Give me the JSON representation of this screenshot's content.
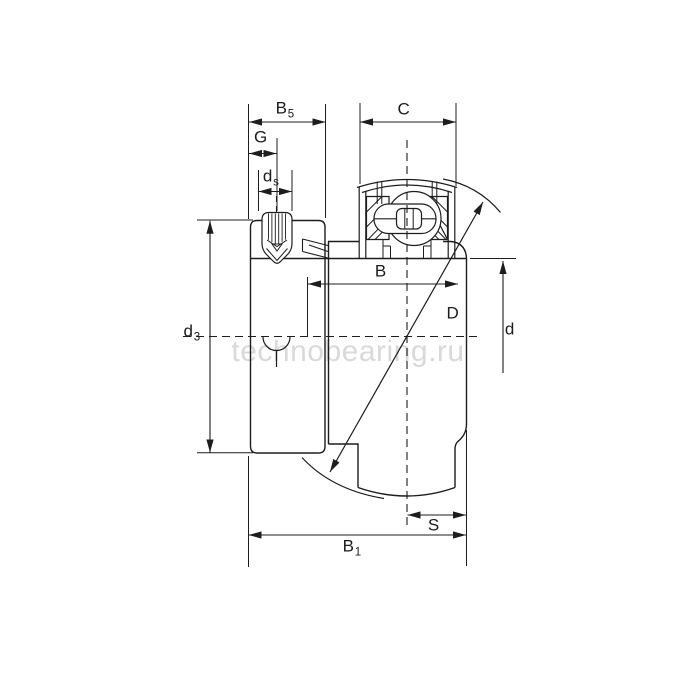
{
  "page": {
    "background": "#ffffff"
  },
  "drawing": {
    "figure_type": "bearing engineering line drawing",
    "line_color": "#1d1d1d"
  },
  "watermark": {
    "text": "technobearing.ru",
    "color": "#d9d9d9"
  },
  "labels": {
    "b5": {
      "base": "B",
      "sub": "5"
    },
    "g": {
      "base": "G",
      "sub": ""
    },
    "ds": {
      "base": "d",
      "sub": "s"
    },
    "c": {
      "base": "C",
      "sub": ""
    },
    "b": {
      "base": "B",
      "sub": ""
    },
    "d_outer": {
      "base": "D",
      "sub": ""
    },
    "d_bore": {
      "base": "d",
      "sub": ""
    },
    "d3": {
      "base": "d",
      "sub": "3"
    },
    "s": {
      "base": "S",
      "sub": ""
    },
    "b1": {
      "base": "B",
      "sub": "1"
    }
  }
}
